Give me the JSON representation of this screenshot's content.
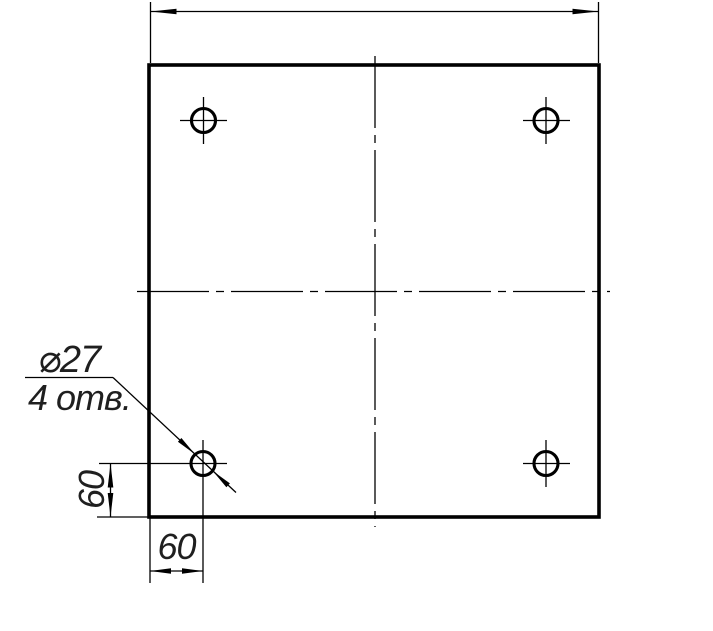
{
  "drawing": {
    "type": "technical-drawing",
    "description": "Square plate, four through holes, GOST-style dimensioning",
    "colors": {
      "line": "#000000",
      "text": "#1f1f1f",
      "background": "#ffffff"
    },
    "callout": {
      "diameter": "⌀27",
      "count": "4 отв."
    },
    "dimensions": {
      "hole_offset_vertical": "60",
      "hole_offset_horizontal": "60"
    }
  }
}
